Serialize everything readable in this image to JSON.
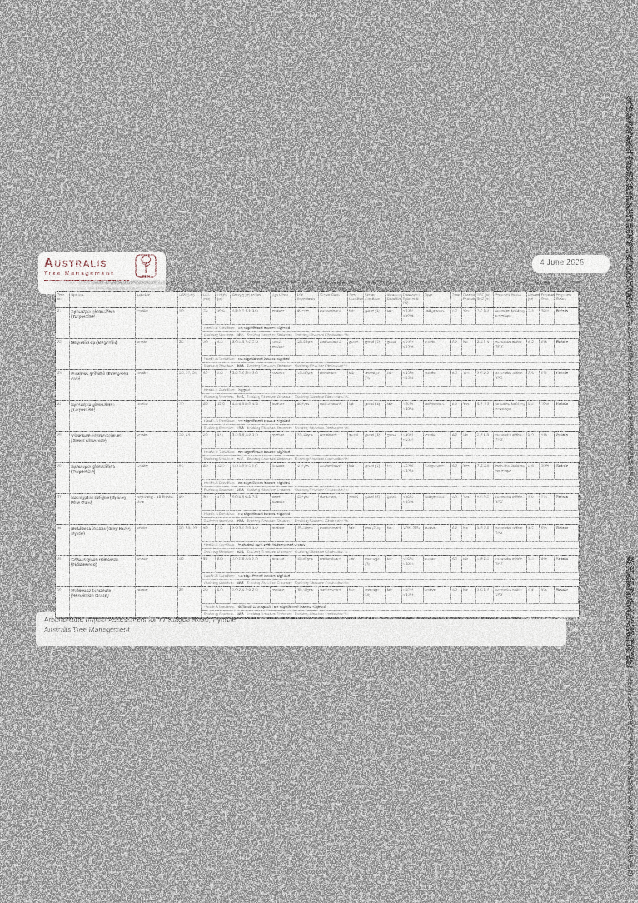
{
  "page": {
    "date": "4 June 2025",
    "logo": {
      "name_cap": "A",
      "name_rest": "USTRALIS",
      "subtitle": "Tree Management"
    },
    "footer": {
      "line1": "Arboriculture Impact Assessment for 77 Kulgoa Road, Pymble",
      "line2": "Australis Tree Management",
      "reference": "Reference 20252167.3",
      "page_number": "58 / 93"
    }
  },
  "table": {
    "headers": [
      "Tree No",
      "Species",
      "Location",
      "DBH (cm)",
      "DSL (cm)",
      "Height (m)",
      "Canopy (m) radius",
      "Age Class",
      "Life Expectancy",
      "Crown Class",
      "Tree Condition",
      "Crown Condition",
      "Structure Condition",
      "Deadwood Epicormic (%)",
      "Type",
      "Zone",
      "Council Protected",
      "TPZ (m) SRZ (m)",
      "Proposed Works",
      "Distance (m)",
      "Proposed Encr.",
      "Proposed Status"
    ],
    "sub_labels": {
      "health": "Health & Condition:",
      "evolving": "Evolving Structure:",
      "evolving_distance": "Evolving Structure Distance:",
      "evolving_obstruction": "Evolving Structure Obstruction %:"
    },
    "rows": [
      {
        "no": "21",
        "species": "Syncarpia glomulifera (Turpentine)",
        "location": "onsite",
        "dbh": "90",
        "cells": [
          "70",
          "10.0",
          "4.5 5.5 4.5 5.0",
          "mature",
          "40+yrs",
          "codominant",
          "fair",
          "good (4)",
          "fair",
          "<10% <10%",
          "indigenous",
          "A2",
          "Yes",
          "7.2 3.4",
          "includes building envelope",
          "3.5",
          "28%",
          "Retain"
        ],
        "health": "no significant issues sighted",
        "evolving": "N/A"
      },
      {
        "no": "22",
        "species": "Magnolia sp (Magnolia)",
        "location": "onsite",
        "dbh": "20",
        "cells": [
          "20",
          "4.0",
          "3.0 3.0 3.0 3.0",
          "semi-mature",
          "15-40yrs",
          "codominant",
          "good",
          "good (4)",
          "good",
          "<10% <10%",
          "exotic",
          "A2",
          "No",
          "2.4 1.5",
          "no works within TPZ",
          "4.2",
          "0%",
          "Retain"
        ],
        "health": "no significant issues sighted",
        "evolving": "N/A"
      },
      {
        "no": "23",
        "species": "Fraxinus griffithii (Evergreen Ash)",
        "location": "onsite",
        "dbh": "30, 20, 20",
        "cells": [
          "40",
          "6.0",
          "3.0 3.0 3.0 3.0",
          "mature",
          "15-40yrs",
          "dominant",
          "fair",
          "average (3)",
          "fair",
          "<10% <10%",
          "exotic",
          "A2",
          "Yes",
          "3.6 2.2",
          "no works within TPZ",
          "2.8",
          "0%",
          "Retain"
        ],
        "health": "lopped",
        "evolving": "N/A"
      },
      {
        "no": "24",
        "species": "Syncarpia glomulifera (Turpentine)",
        "location": "onsite",
        "dbh": "70",
        "cells": [
          "80",
          "12.0",
          "4.5 6.0 6.0 4.5",
          "mature",
          "40+yrs",
          "codominant",
          "fair",
          "good (4)",
          "fair",
          "<10% <10%",
          "indigenous",
          "A2",
          "Yes",
          "8.4 3.0",
          "includes building envelope",
          "8.6",
          "10%",
          "Retain"
        ],
        "health": "no significant issues sighted",
        "evolving": "N/A"
      },
      {
        "no": "25",
        "species": "Viburnum odoratissimum (Sweet Viburnum)",
        "location": "onsite",
        "dbh": "10, 15",
        "cells": [
          "20",
          "6.0",
          "3.0 3.0 3.0 3.0",
          "mature",
          "15-40yrs",
          "dominant",
          "good",
          "good (4)",
          "good",
          "<10% <10%",
          "exotic",
          "A2",
          "No",
          "2.4 1.5",
          "no works within TPZ",
          "5.0",
          "0%",
          "Retain"
        ],
        "health": "no significant issues sighted",
        "evolving": "N/A"
      },
      {
        "no": "26",
        "species": "Syncarpia glomulifera (Turpentine)",
        "location": "onsite",
        "dbh": "60",
        "cells": [
          "80",
          "15.0",
          "5.0 5.0 5.0 5.0",
          "mature",
          "40+yrs",
          "codominant",
          "fair",
          "good (4)",
          "fair",
          "<10% <10%",
          "indigenous",
          "A2",
          "Yes",
          "7.2 3.0",
          "includes building envelope",
          "6.6",
          "10%",
          "Retain"
        ],
        "health": "no significant issues sighted",
        "evolving": "N/A"
      },
      {
        "no": "27",
        "species": "Eucalyptus saligna (Sydney Blue Gum)",
        "location": "adjoining - 16 Bristol Ave",
        "dbh": "50",
        "cells": [
          "80",
          "17.0",
          "6.0 6.0 6.5 7.5",
          "semi-mature",
          "40+yrs",
          "dominant",
          "good",
          "good (4)",
          "good",
          "<10% <10%",
          "indigenous",
          "A2",
          "Yes",
          "9.6 3.2",
          "no works within TPZ",
          "6.0",
          "0%",
          "Retain"
        ],
        "health": "no significant issues sighted",
        "evolving": "N/A"
      },
      {
        "no": "28",
        "species": "Melaleuca incana (Grey Honey Myrtle)",
        "location": "onsite",
        "dbh": "20, 15, 20",
        "cells": [
          "50",
          "7.0",
          "3.0 3.0 3.0 3.0",
          "mature",
          "15-40yrs",
          "codominant",
          "fair",
          "low (2.5)",
          "fair",
          "10%-25%",
          "native",
          "A2",
          "No",
          "3.6 2.0",
          "no works within TPZ",
          "3.2",
          "0%",
          "Retain"
        ],
        "health": "included bark with tridominant stems",
        "evolving": "N/A"
      },
      {
        "no": "29",
        "species": "Citharexylum spinosum (Fiddlewood)",
        "location": "onsite",
        "dbh": "40",
        "cells": [
          "55",
          "8.0",
          "3.0 3.0 3.0 3.0",
          "mature",
          "15-40yrs",
          "codominant",
          "fair",
          "average (3)",
          "fair",
          "<10% <10%",
          "exotic",
          "A2",
          "No",
          "4.8 2.3",
          "no works within TPZ",
          "3.8",
          "0%",
          "Retain"
        ],
        "health": "no significant issues sighted",
        "evolving": "N/A"
      },
      {
        "no": "30",
        "species": "Melaleuca bracteata (Revolution Green)",
        "location": "onsite",
        "dbh": "25",
        "cells": [
          "20",
          "6.0",
          "3.0 2.0 3.0 2.0",
          "mature",
          "15-40yrs",
          "codominant",
          "fair",
          "average (3)",
          "fair",
          "<10% <10%",
          "native",
          "A2",
          "No",
          "3.0 1.8",
          "no works within TPZ",
          "4.4",
          "0%",
          "Retain"
        ],
        "health": "difficult to inspect / no significant issues sighted",
        "evolving": "N/A"
      }
    ]
  }
}
